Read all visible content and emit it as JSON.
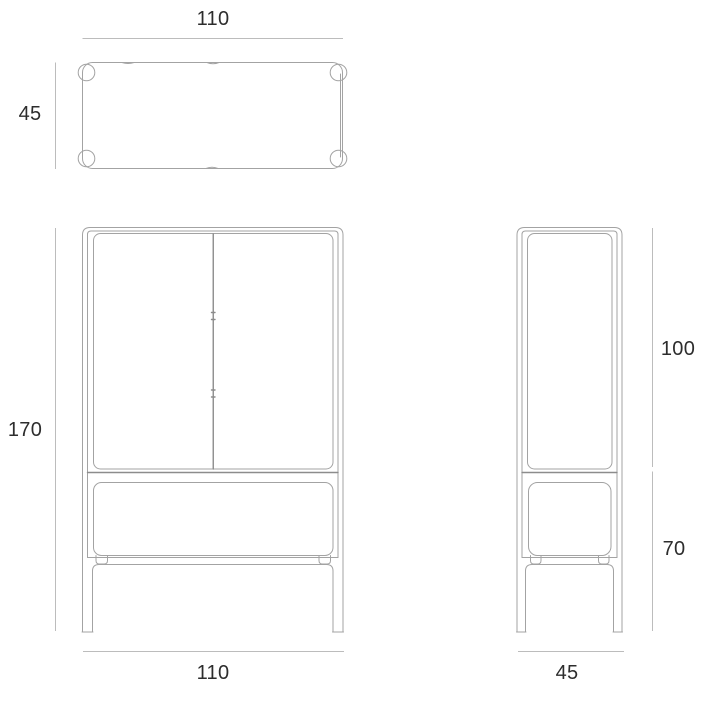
{
  "colors": {
    "background": "#ffffff",
    "furniture_line": "#a3a3a3",
    "furniture_line_dark": "#8c8c8c",
    "dimension_line": "#bcbcbc",
    "label_text": "#2d2d2d"
  },
  "views": {
    "top": {
      "width": "110",
      "depth": "45"
    },
    "front": {
      "height": "170",
      "width": "110"
    },
    "side": {
      "upper_height": "100",
      "lower_height": "70",
      "depth": "45"
    }
  }
}
